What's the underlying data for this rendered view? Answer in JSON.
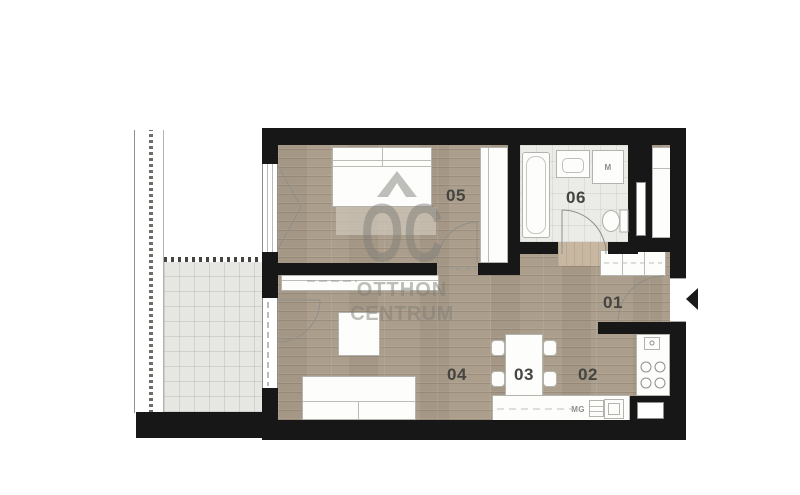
{
  "watermark": {
    "logo": "OC",
    "line1": "OTTHON",
    "line2": "CENTRUM"
  },
  "rooms": {
    "entry": "01",
    "kitchen": "02",
    "dining": "03",
    "living": "04",
    "bedroom": "05",
    "bathroom": "06"
  },
  "appliances": {
    "washing_machine": "M",
    "dishwasher": "MG"
  },
  "colors": {
    "wall": "#171717",
    "wood": "#ac9e8c",
    "balcony_tile": "#e6e6e2",
    "bath_tile": "#ebebe8",
    "threshold": "#c8b8a1",
    "watermark": "#807f78",
    "room_label": "#444441"
  }
}
